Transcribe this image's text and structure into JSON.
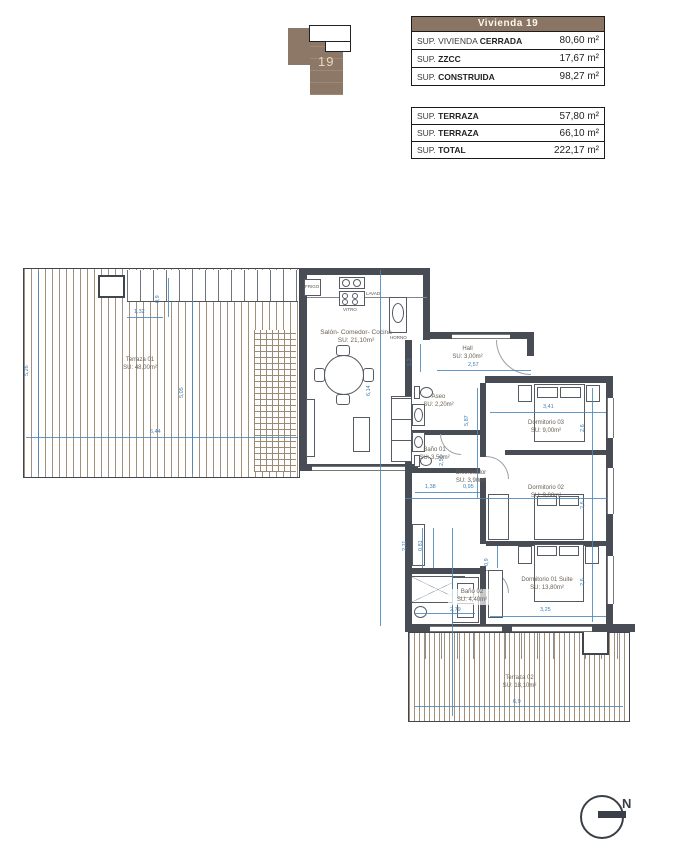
{
  "logo": {
    "number": "19"
  },
  "tables": {
    "main": {
      "header": "Vivienda 19",
      "rows": [
        {
          "label_light": "SUP. VIVIENDA",
          "label_bold": "CERRADA",
          "value": "80,60 m²"
        },
        {
          "label_light": "SUP.",
          "label_bold": "ZZCC",
          "value": "17,67 m²"
        },
        {
          "label_light": "SUP.",
          "label_bold": "CONSTRUIDA",
          "value": "98,27 m²"
        }
      ]
    },
    "secondary": {
      "rows": [
        {
          "label_light": "SUP.",
          "label_bold": "TERRAZA",
          "value": "57,80 m²"
        },
        {
          "label_light": "SUP.",
          "label_bold": "TERRAZA",
          "value": "66,10 m²"
        },
        {
          "label_light": "SUP.",
          "label_bold": "TOTAL",
          "value": "222,17 m²"
        }
      ]
    }
  },
  "plan": {
    "rooms": {
      "terraza01": {
        "name": "Terraza 01",
        "area": "SU: 48,00m²"
      },
      "salon": {
        "name": "Salón- Comedor- Cocina",
        "area": "SU: 21,10m²"
      },
      "hall": {
        "name": "Hall",
        "area": "SU: 3,00m²"
      },
      "aseo": {
        "name": "Aseo",
        "area": "SU: 2,20m²"
      },
      "bano01": {
        "name": "Baño 01",
        "area": "SU: 3,50m²"
      },
      "distribuidor": {
        "name": "Distribuidor",
        "area": "SU: 3,90m²"
      },
      "dorm03": {
        "name": "Dormitorio 03",
        "area": "SU: 9,00m²"
      },
      "dorm02": {
        "name": "Dormitorio 02",
        "area": "SU: 9,00m²"
      },
      "dorm01": {
        "name": "Dormitorio 01 Suite",
        "area": "SU: 13,80m²"
      },
      "bano02": {
        "name": "Baño 02",
        "area": "SU: 4,40m²"
      },
      "terraza02": {
        "name": "Terraza 02",
        "area": "SU: 18,10m²"
      }
    },
    "kitchen_labels": {
      "fridge": "FRIGO",
      "hob": "VITRO",
      "washer": "LAVAD.",
      "oven": "HORNO"
    },
    "dims": {
      "d1": "5,26",
      "d2": "5,05",
      "d3": "6,44",
      "d4": "1,32",
      "d5": "0,9",
      "d6": "6,14",
      "d7": "1,2",
      "d8": "2,57",
      "d9": "5,87",
      "d10": "2,56",
      "d11": "1,38",
      "d12": "0,95",
      "d13": "3,41",
      "d14": "2,6",
      "d15": "2,6",
      "d16": "2,6",
      "d17": "3,25",
      "d18": "0,9",
      "d19": "2,11",
      "d20": "0,81",
      "d21": "2,79",
      "d22": "6,9"
    }
  },
  "compass": {
    "north": "N"
  },
  "colors": {
    "brand_brown": "#8a7464",
    "wall": "#474c55",
    "dimension_blue": "#3f7fb5"
  }
}
